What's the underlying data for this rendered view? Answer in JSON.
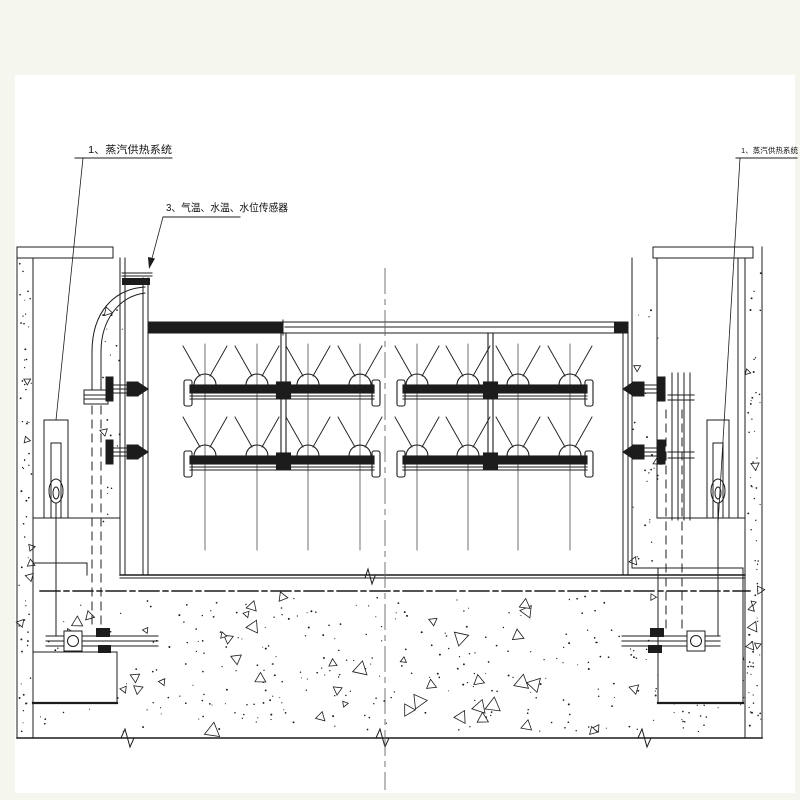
{
  "drawing": {
    "type": "engineering-cad-section",
    "title_context": "gate steam heating system section",
    "labels": {
      "steam_left": "1、蒸汽供热系统",
      "sensors": "3、气温、水温、水位传感器",
      "steam_right": "1、蒸汽供热系统"
    },
    "colors": {
      "background": "#f5f7ef",
      "paper": "#ffffff",
      "ink": "#1c1c1c",
      "centerline": "#666666"
    }
  }
}
